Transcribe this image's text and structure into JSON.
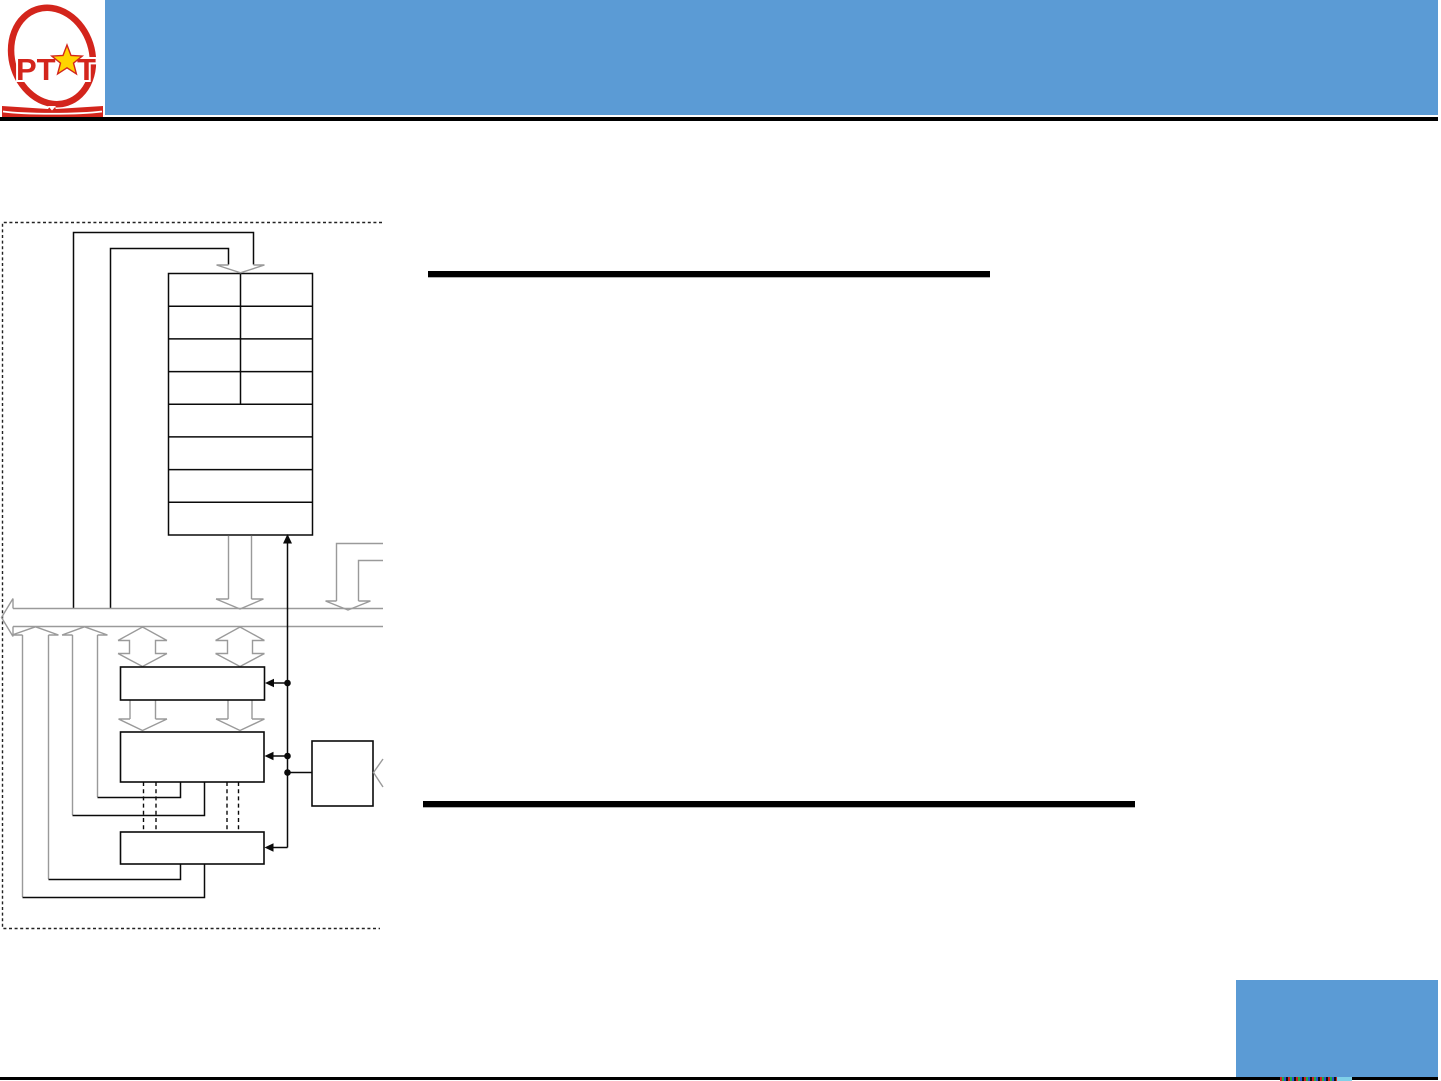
{
  "slide": {
    "logo": {
      "text_left": "PT",
      "text_right": "T",
      "star_glyph": "★"
    }
  },
  "colors": {
    "accent_blue": "#5B9BD5",
    "logo_red": "#D3251C",
    "star_yellow": "#FFD400",
    "ink_black": "#0a0a0a",
    "line_gray": "#9a9a9a"
  },
  "diagram": {
    "register_table": {
      "row_count": 8,
      "split_row_count": 4
    }
  },
  "footer": {
    "micro_text_colors": [
      "#cc2222",
      "#22aa44",
      "#2255cc",
      "#111111"
    ],
    "micro_tail_color": "#7fd0e8"
  }
}
